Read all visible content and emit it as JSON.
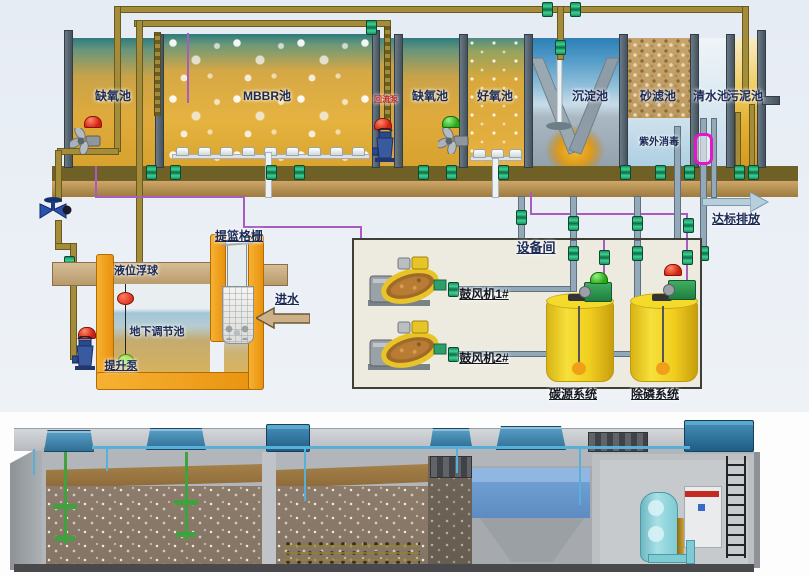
{
  "schematic": {
    "tanks": [
      {
        "label": "缺氧池"
      },
      {
        "label": "MBBR池"
      },
      {
        "label": "缺氧池"
      },
      {
        "label": "好氧池"
      },
      {
        "label": "沉淀池"
      },
      {
        "label": "砂滤池"
      },
      {
        "label": "清水池"
      },
      {
        "label": "污泥池"
      }
    ],
    "reflux_pump": "回流泵",
    "uv": "紫外消毒",
    "discharge": "达标排放",
    "intake": {
      "screen": "提篮格栅",
      "float_ball": "液位浮球",
      "inflow": "进水",
      "tank": "地下调节池",
      "pump": "提升泵"
    },
    "equipment_room": {
      "title": "设备间",
      "blowers": [
        {
          "label": "鼓风机1#"
        },
        {
          "label": "鼓风机2#"
        }
      ],
      "dosing": [
        {
          "label": "碳源系统"
        },
        {
          "label": "除磷系统"
        }
      ]
    },
    "colors": {
      "tank_gold": "#e0ab3c",
      "water_blue": "#2d7fb5",
      "pipe_air_olive": "#a38c3a",
      "pipe_dosing_purple": "#a95cc0",
      "structure_orange": "#f2a51f",
      "uv_magenta": "#e018c8",
      "alarm_red": "#d02010",
      "alarm_green": "#2aa818",
      "dosing_tank_yellow": "#f0ce1e"
    }
  }
}
